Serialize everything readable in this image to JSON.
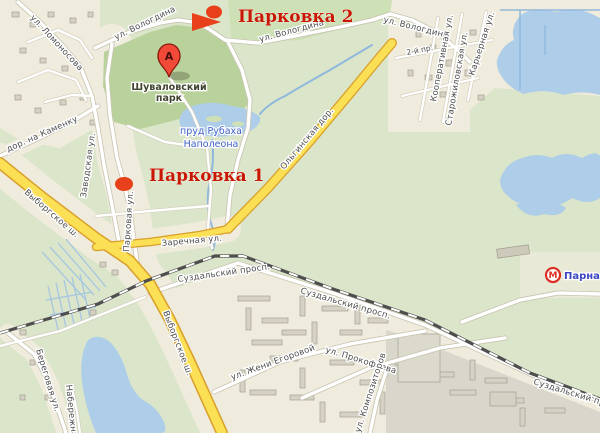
{
  "map": {
    "markers": {
      "parking1": {
        "label": "Парковка 1"
      },
      "parking2": {
        "label": "Парковка 2"
      },
      "pin": {
        "letter": "А"
      },
      "metro": {
        "symbol": "М",
        "label": "Парнас"
      }
    },
    "places": {
      "park": {
        "line1": "Шуваловский",
        "line2": "парк"
      },
      "pond": {
        "line1": "пруд Рубаха",
        "line2": "Наполеона"
      }
    },
    "streets": {
      "lomonosova": "ул. Ломоносова",
      "vologdina": "ул. Вологдина",
      "vtoroy_pr": "2-й пр.",
      "kooperativnaya": "Кооперативная ул.",
      "starozhilovskaya": "Старожиловская ул.",
      "karyernaya": "Карьерная ул.",
      "dor_na_kamenku": "дор. на Каменку",
      "zavodskaya": "Заводская ул.",
      "parkovaya": "Парковая ул.",
      "vyborgskoe": "Выборгское ш.",
      "zarechnaya": "Заречная ул.",
      "olginskaya": "Ольгинская дор.",
      "suzdalsky": "Суздальский просп.",
      "zheni_egorovoy": "ул. Жени Егоровой",
      "prokofyeva": "ул. Прокофьева",
      "kompozitorov": "ул. Композиторов",
      "beregovaya": "Береговая ул.",
      "naberezhnaya": "Набережная"
    },
    "colors": {
      "route_red": "#e8401a",
      "parking_text_red": "#c81804",
      "road_yellow": "#fbdf55",
      "road_yellow_border": "#d99f2b",
      "park_green": "#b9d29c",
      "background_green": "#dbe5c9",
      "urban_beige": "#f0ecdd",
      "water_blue": "#aecde9",
      "water_label_blue": "#3b5ec6",
      "metro_red": "#dd2f23",
      "metro_label_blue": "#3946c0"
    }
  }
}
